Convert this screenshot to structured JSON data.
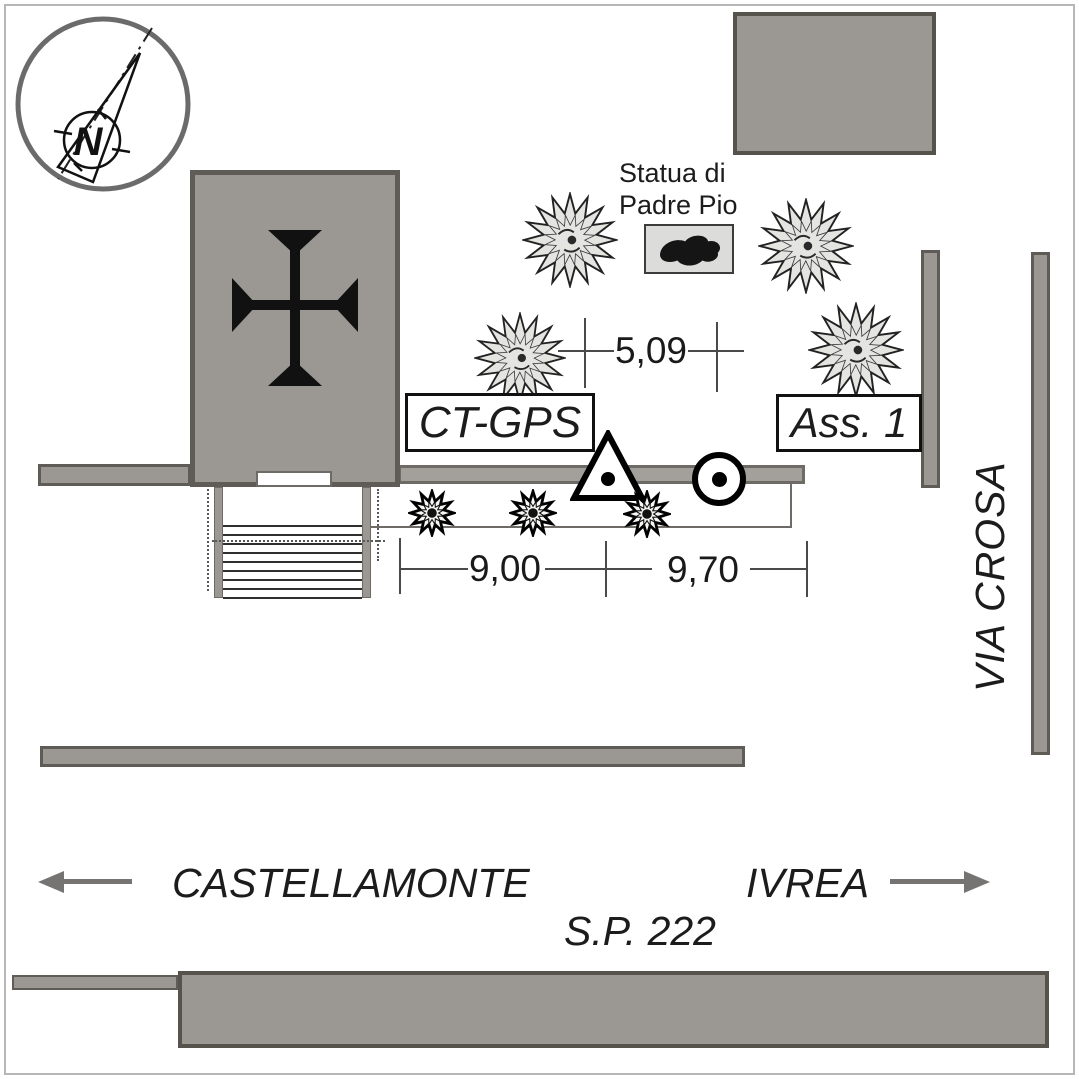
{
  "diagram": {
    "title_hint": "GPS survey station site sketch",
    "compass": {
      "north_label": "N"
    },
    "statue": {
      "label_line1": "Statua di",
      "label_line2": "Padre Pio"
    },
    "station": {
      "label": "CT-GPS"
    },
    "assist": {
      "label": "Ass. 1"
    },
    "streets": {
      "vertical": "VIA CROSA",
      "destination_left": "CASTELLAMONTE",
      "destination_right": "IVREA",
      "road": "S.P. 222"
    },
    "dimensions": {
      "statue_to_wall": "5,09",
      "segment_left": "9,00",
      "segment_right": "9,70"
    },
    "icons": [
      "north-compass-icon",
      "church-cross-icon",
      "tree-icon",
      "bush-icon",
      "station-triangle-icon",
      "reference-circle-icon",
      "statue-footprint-icon",
      "arrow-left-icon",
      "arrow-right-icon"
    ],
    "colors": {
      "block_fill": "#9b9894",
      "block_outline": "#5f5c57",
      "line": "#4a4a4a",
      "arrow": "#757472",
      "statue_box_fill": "#dcdcda"
    }
  }
}
